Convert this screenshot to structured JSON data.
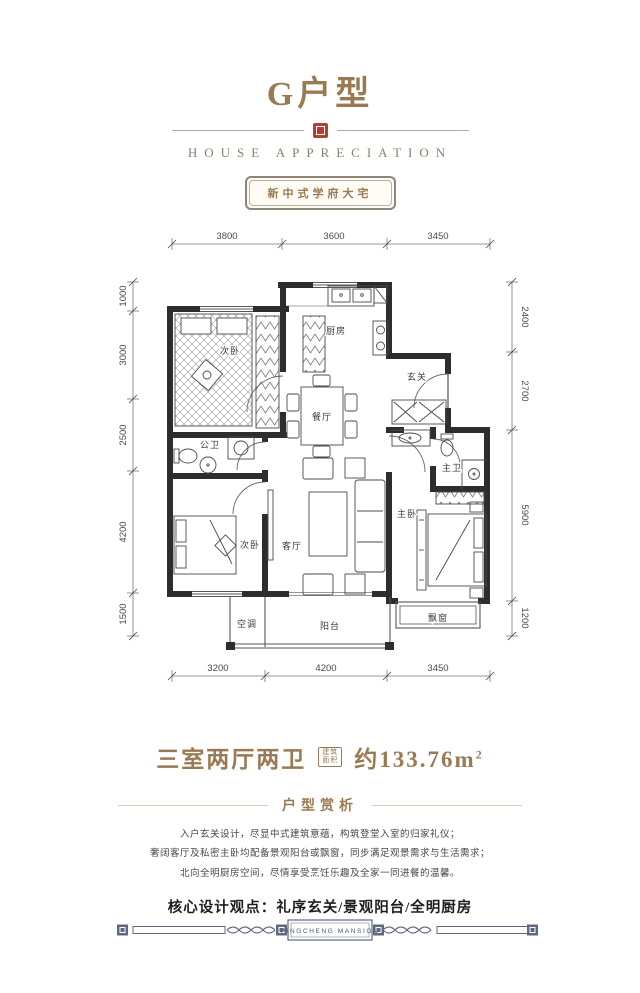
{
  "header": {
    "title": "G户型",
    "subtitle": "HOUSE APPRECIATION",
    "badge": "新中式学府大宅"
  },
  "plan": {
    "rooms": {
      "bedroom_top": "次卧",
      "kitchen": "厨房",
      "entry": "玄关",
      "dining": "餐厅",
      "bath_guest": "公卫",
      "bedroom_second": "次卧",
      "living": "客厅",
      "bedroom_master": "主卧",
      "bath_master": "主卫",
      "ac": "空调",
      "balcony": "阳台",
      "baywindow": "飘窗"
    },
    "dims": {
      "top": [
        "3800",
        "3600",
        "3450"
      ],
      "bottom": [
        "3200",
        "4200",
        "3450"
      ],
      "left": [
        "1000",
        "3000",
        "2500",
        "4200",
        "1500"
      ],
      "right": [
        "2400",
        "2700",
        "5900",
        "1200"
      ]
    }
  },
  "summary": {
    "layout": "三室两厅两卫",
    "area_badge_line1": "建筑",
    "area_badge_line2": "面积",
    "area_value": "约133.76m",
    "area_sup": "2"
  },
  "analysis": {
    "heading": "户型赏析",
    "lines": [
      "入户玄关设计，尽显中式建筑意蕴，构筑登堂入室的归家礼仪；",
      "奢阔客厅及私密主卧均配备景观阳台或飘窗，同步满足观景需求与生活需求；",
      "北向全明厨房空间，尽情享受烹饪乐趣及全家一同进餐的温馨。"
    ],
    "keypoints": "核心设计观点：礼序玄关/景观阳台/全明厨房"
  },
  "footer": {
    "brand": "PINGCHENG MANSION"
  },
  "colors": {
    "gold": "#9a7a52",
    "seal_red": "#b2402e",
    "wall": "#2d2d2d",
    "footer_blue": "#5f6880"
  }
}
